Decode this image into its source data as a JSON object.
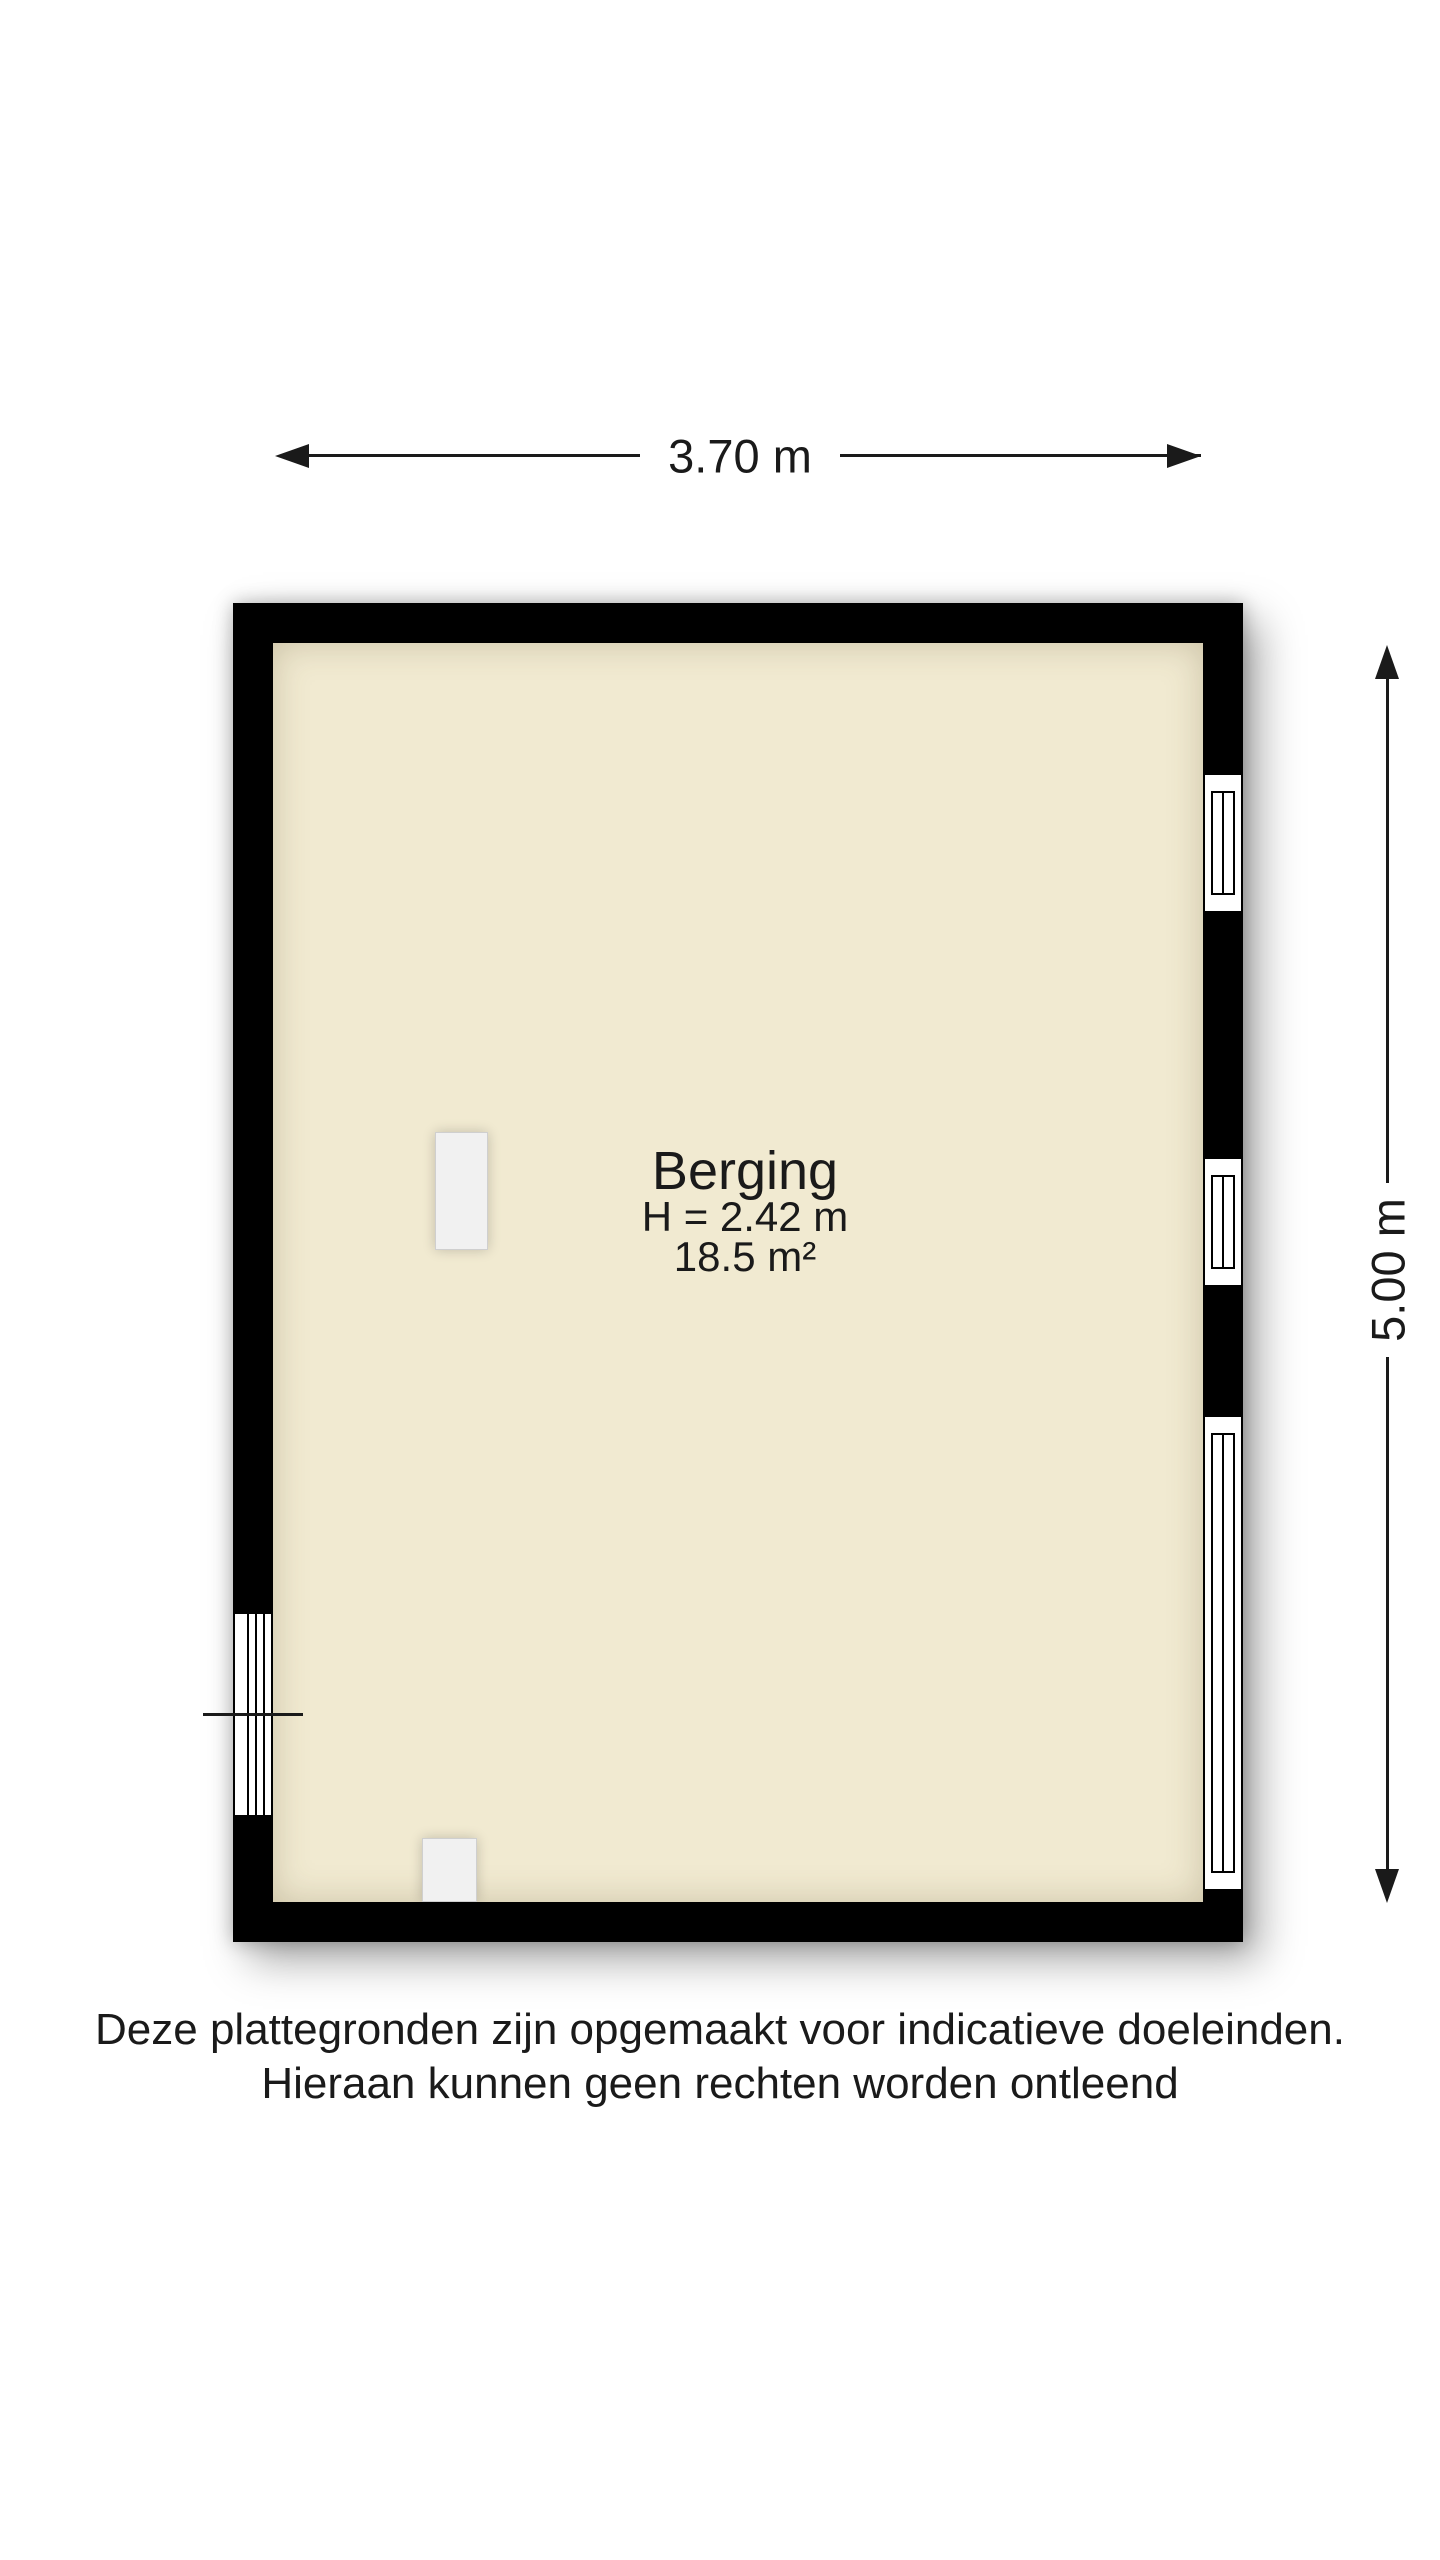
{
  "room": {
    "name": "Berging",
    "ceiling_height": "H = 2.42 m",
    "area": "18.5 m²"
  },
  "dimensions": {
    "width": "3.70 m",
    "height": "5.00 m"
  },
  "disclaimer": {
    "line1": "Deze plattegronden zijn opgemaakt voor indicatieve doeleinden.",
    "line2": "Hieraan kunnen geen rechten worden ontleend"
  },
  "colors": {
    "floor": "#f1ead1",
    "wall": "#000000",
    "fixture": "#f1f1f1",
    "page_background": "#ffffff",
    "text": "#1a1a1a"
  }
}
